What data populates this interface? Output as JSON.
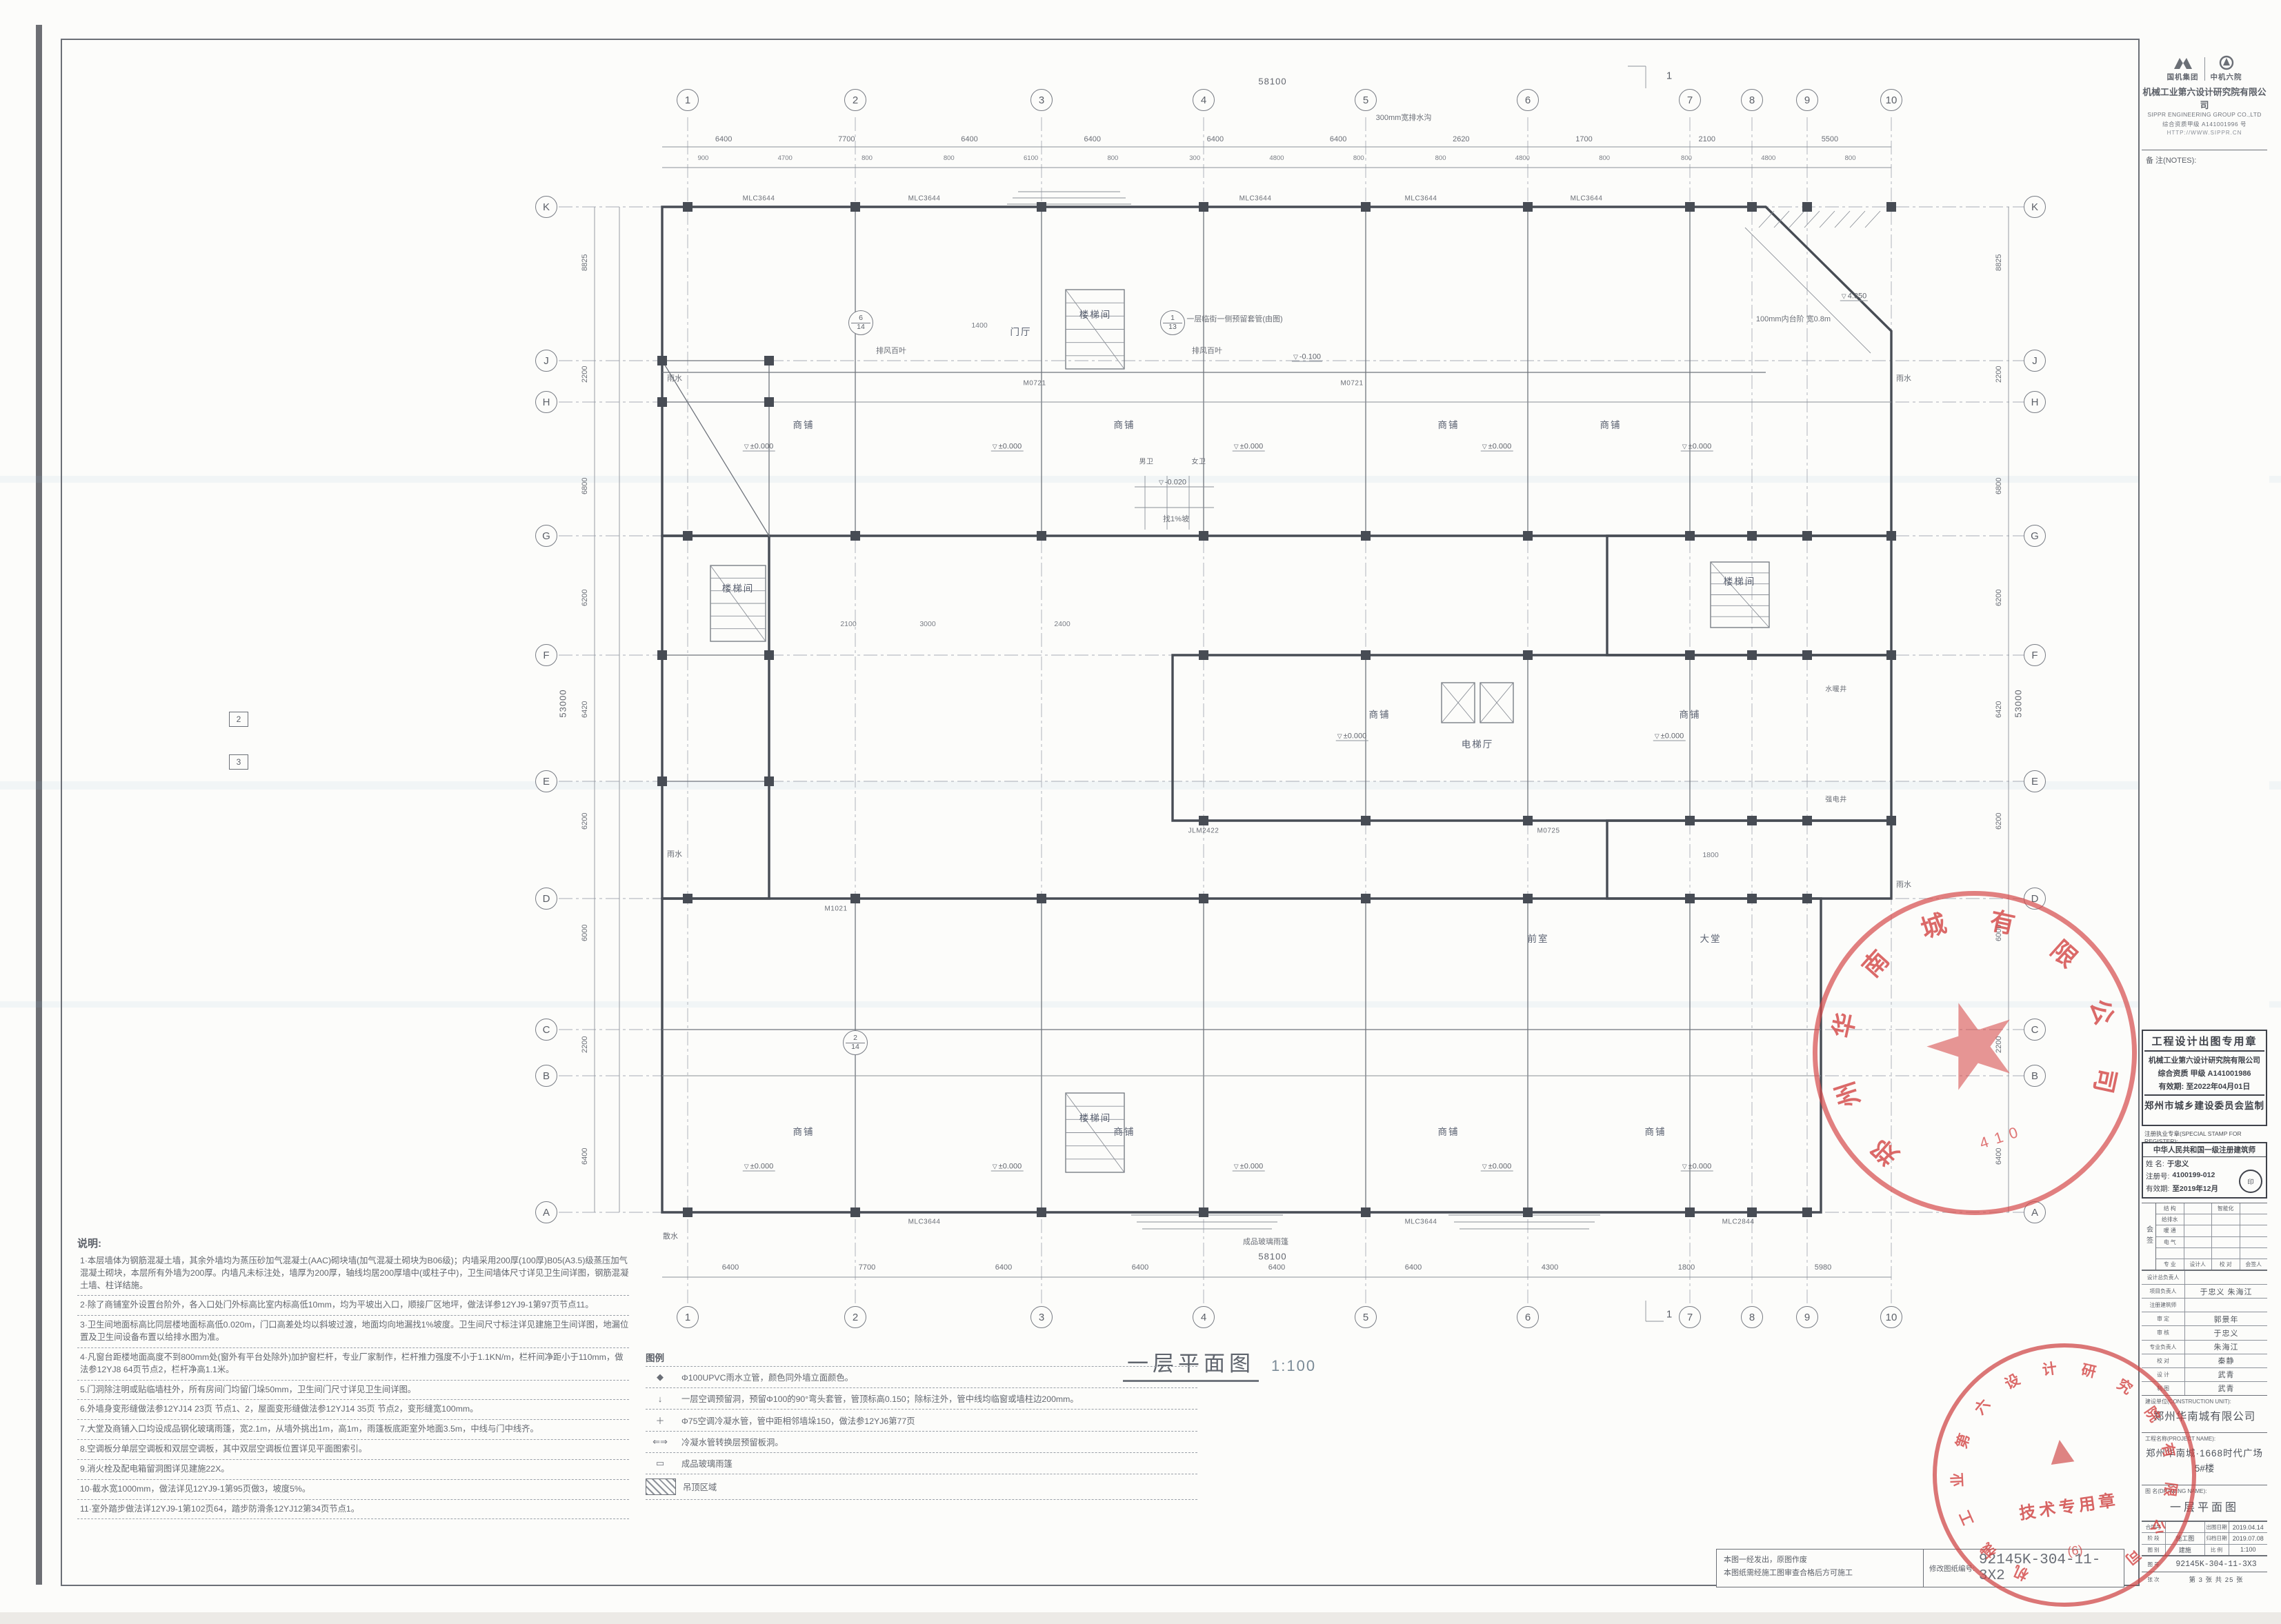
{
  "header": {
    "brand1": "国机集团",
    "brand2": "中机六院",
    "company": "机械工业第六设计研究院有限公司",
    "company_en": "SIPPR ENGINEERING GROUP CO.,LTD",
    "cert": "综合资质甲级 A141001996 号",
    "url": "HTTP://WWW.SIPPR.CN",
    "notes_label": "备 注(NOTES):"
  },
  "plan": {
    "title": "一层平面图",
    "scale": "1:100",
    "top_grid": [
      "1",
      "2",
      "3",
      "4",
      "5",
      "6",
      "7",
      "8",
      "9",
      "10"
    ],
    "side_grid": [
      "K",
      "J",
      "H",
      "G",
      "F",
      "E",
      "D",
      "C",
      "B",
      "A"
    ],
    "top_dims": [
      "6400",
      "7700",
      "6400",
      "6400",
      "6400",
      "6400",
      "2620",
      "1700",
      "2100",
      "5500"
    ],
    "top_subdims": [
      "900",
      "4700",
      "800",
      "800",
      "6100",
      "800",
      "300",
      "4800",
      "800",
      "800",
      "4800",
      "800",
      "800",
      "4800",
      "800"
    ],
    "bottom_dims": [
      "6400",
      "7700",
      "6400",
      "6400",
      "6400",
      "6400",
      "4300",
      "1800",
      "5980"
    ],
    "left_dims": [
      "8825",
      "2200",
      "6800",
      "6200",
      "6420",
      "6200",
      "6000",
      "2200",
      "6400"
    ],
    "totals": {
      "top": "58100",
      "bottom": "58100",
      "left": "53000",
      "right": "53000"
    },
    "level_symbol": "▽",
    "levels": {
      "zero": "±0.000",
      "entry": "-0.100",
      "wc": "-0.020",
      "canopy": "4.350"
    },
    "rooms": {
      "shop": "商铺",
      "hall": "门厅",
      "lobby": "大堂",
      "stair": "楼梯间",
      "lift": "电梯厅",
      "front": "前室",
      "wc_m": "男卫",
      "wc_f": "女卫",
      "shaft_w": "水暖井",
      "shaft_e": "强电井"
    },
    "tags": [
      "MLC3644",
      "MLC2844",
      "M0721",
      "M0725",
      "M1021",
      "JLM2422"
    ],
    "callouts": [
      "300mm宽排水沟",
      "排风百叶",
      "一层临街一侧预留套管(由图)",
      "成品玻璃雨篷",
      "100mm内台阶 宽0.8m",
      "散水",
      "雨水",
      "找1%坡"
    ],
    "small_dims": [
      "2400",
      "1400",
      "1800",
      "2100",
      "3000"
    ],
    "detail_bubbles": [
      [
        "6",
        "14"
      ],
      [
        "1",
        "13"
      ],
      [
        "2",
        "14"
      ]
    ],
    "section_marks": [
      "1",
      "2",
      "3"
    ]
  },
  "notes": {
    "title": "说明:",
    "items": [
      "1·本层墙体为钢筋混凝土墙，其余外墙均为蒸压砂加气混凝土(AAC)砌块墙(加气混凝土砌块为B06级)；内墙采用200厚(100厚)B05(A3.5)级蒸压加气混凝土砌块，本层所有外墙为200厚。内墙凡未标注处，墙厚为200厚，轴线均居200厚墙中(或柱子中)，卫生间墙体尺寸详见卫生间详图，钢筋混凝土墙、柱详结施。",
      "2·除了商铺室外设置台阶外，各入口处门外标高比室内标高低10mm，均为平坡出入口，顺接厂区地坪，做法详参12YJ9-1第97页节点11。",
      "3·卫生间地面标高比同层楼地面标高低0.020m，门口高差处均以斜坡过渡，地面均向地漏找1%坡度。卫生间尺寸标注详见建施卫生间详图，地漏位置及卫生间设备布置以给排水图为准。",
      "4·凡窗台距楼地面高度不到800mm处(窗外有平台处除外)加护窗栏杆，专业厂家制作，栏杆推力强度不小于1.1KN/m，栏杆间净距小于110mm，做法参12YJ8 64页节点2，栏杆净高1.1米。",
      "5.门洞除注明或贴临墙柱外，所有房间门均留门垛50mm，卫生间门尺寸详见卫生间详图。",
      "6.外墙身变形缝做法参12YJ14 23页 节点1、2，屋面变形缝做法参12YJ14 35页 节点2，变形缝宽100mm。",
      "7.大堂及商铺入口均设成品钢化玻璃雨篷，宽2.1m，从墙外挑出1m，高1m，雨篷板底距室外地面3.5m，中线与门中线齐。",
      "8.空调板分单层空调板和双层空调板，其中双层空调板位置详见平面图索引。",
      "9.消火栓及配电箱留洞图详见建施22X。",
      "10·截水宽1000mm，做法详见12YJ9-1第95页做3，坡度5%。",
      "11·室外踏步做法详12YJ9-1第102页64，踏步防滑条12YJ12第34页节点1。"
    ]
  },
  "legend": {
    "title": "图例",
    "items": [
      {
        "sym": "◆",
        "hatch": false,
        "text": "Φ100UPVC雨水立管，颜色同外墙立面颜色。"
      },
      {
        "sym": "↓",
        "hatch": false,
        "text": "一层空调预留洞，预留Φ100的90°弯头套管，管顶标高0.150；除标注外，管中线均临窗或墙柱边200mm。"
      },
      {
        "sym": "＋",
        "hatch": false,
        "text": "Φ75空调冷凝水管，管中距相邻墙垛150，做法参12YJ6第77页"
      },
      {
        "sym": "⇐⇒",
        "hatch": false,
        "text": "冷凝水管转换层预留板洞。"
      },
      {
        "sym": "▭",
        "hatch": false,
        "text": "成品玻璃雨篷"
      },
      {
        "sym": "",
        "hatch": true,
        "text": "吊顶区域"
      }
    ]
  },
  "design_stamp": {
    "l1": "工程设计出图专用章",
    "l2": "机械工业第六设计研究院有限公司",
    "l3": "综合资质 甲级 A141001986",
    "l4": "有效期: 至2022年04月01日",
    "l5": "郑州市城乡建设委员会监制"
  },
  "register_label": "注册执业专章(SPECIAL STAMP FOR REGISTER):",
  "architect_stamp": {
    "title": "中华人民共和国一级注册建筑师",
    "name_label": "姓 名:",
    "name": "于忠义",
    "no_label": "注册号:",
    "no": "4100199-012",
    "valid_label": "有效期:",
    "valid": "至2019年12月"
  },
  "sign_table": {
    "side": "会签",
    "rows": [
      [
        "结 构",
        "",
        "智能化",
        ""
      ],
      [
        "给排水",
        "",
        "",
        ""
      ],
      [
        "暖 通",
        "",
        "",
        ""
      ],
      [
        "电 气",
        "",
        "",
        ""
      ],
      [
        "",
        "",
        "",
        ""
      ]
    ],
    "footer": [
      "专 业",
      "设计人",
      "校 对",
      "会签人"
    ]
  },
  "name_rows": [
    {
      "label": "设计总负责人",
      "value": ""
    },
    {
      "label": "项目负责人",
      "value": "于忠义 朱海江"
    },
    {
      "label": "注册建筑师",
      "value": ""
    },
    {
      "label": "审 定",
      "value": "郭景年"
    },
    {
      "label": "审 核",
      "value": "于忠义"
    },
    {
      "label": "专业负责人",
      "value": "朱海江"
    },
    {
      "label": "校 对",
      "value": "秦静"
    },
    {
      "label": "设 计",
      "value": "武青"
    },
    {
      "label": "制 图",
      "value": "武青"
    }
  ],
  "construction_unit": {
    "label": "建设单位(CONSTRUCTION UNIT):",
    "value": "郑州华南城有限公司"
  },
  "project": {
    "label": "工程名称(PROJECT NAME):",
    "value": "郑州华南城·1668时代广场",
    "value2": "5#楼"
  },
  "drawing_name": {
    "label": "图 名(DRAWING NAME):",
    "value": "一层平面图"
  },
  "tb_rows": [
    {
      "cells": [
        "合同号",
        "",
        "出图日期",
        "2019.04.14"
      ]
    },
    {
      "cells": [
        "阶 段",
        "施工图",
        "归档日期",
        "2019.07.08"
      ]
    },
    {
      "cells": [
        "图 别",
        "建施",
        "比 例",
        "1:100"
      ]
    }
  ],
  "tb_no": {
    "label": "图 号",
    "value": "92145K-304-11-3X3"
  },
  "tb_sheet": {
    "label": "张 次",
    "value": "第 3 张 共 25 张"
  },
  "bottom_band": {
    "line1": "本图一经发出，原图作废",
    "line2": "本图纸需经施工图审查合格后方可施工",
    "no_label": "修改图纸编号:",
    "no": "92145K-304-11-3X2"
  },
  "stamp_upper": {
    "company": "郑州华南城有限公司",
    "star": "★",
    "digits": "410"
  },
  "stamp_lower": {
    "company": "机械工业第六设计研究院有限公司",
    "emblem": "▲",
    "label": "技术专用章",
    "sub": "(6)"
  }
}
